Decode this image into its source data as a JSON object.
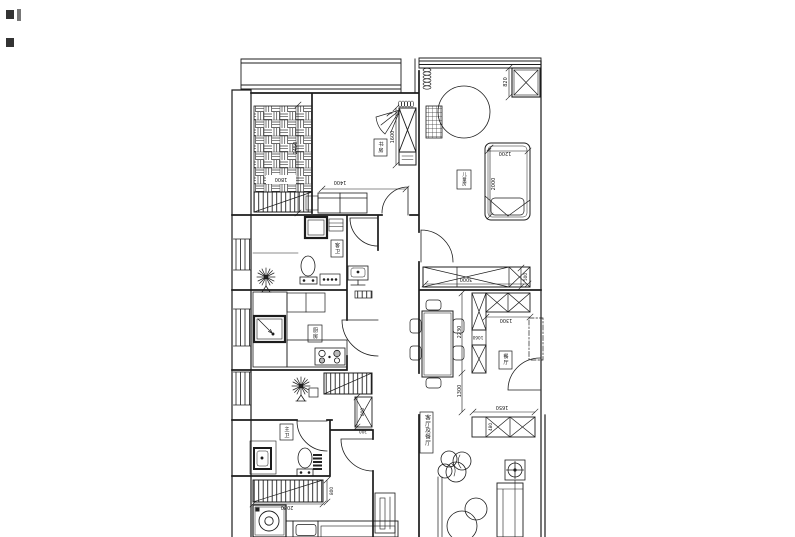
{
  "rooms": {
    "study": "书房",
    "guest_bath": "客卫",
    "kids_room": "儿童房",
    "kitchen": "厨房",
    "dining": "餐厅",
    "living_dining": "客厅及餐厅",
    "master_bath": "主卫"
  },
  "dimensions": {
    "balcony": "1800",
    "study_depth": "2450",
    "study_desk": "1400",
    "study_wardrobe": "1600",
    "kids_cabinet": "820",
    "kids_bed_width": "1200",
    "kids_bed_length": "2000",
    "kids_wardrobe_width": "3000",
    "kids_wardrobe_depth": "500",
    "dining_cabinet_run": "2230",
    "dining_passage": "1300",
    "dining_upper_cabinet": "1300",
    "dining_cabinet_mid": "1060",
    "tv_cabinet_width": "1650",
    "tv_cabinet_depth": "480",
    "hall_radiator_height": "800",
    "hall_radiator_width": "300",
    "bedroom_radiator_width": "2080",
    "bedroom_radiator_depth": "800"
  }
}
